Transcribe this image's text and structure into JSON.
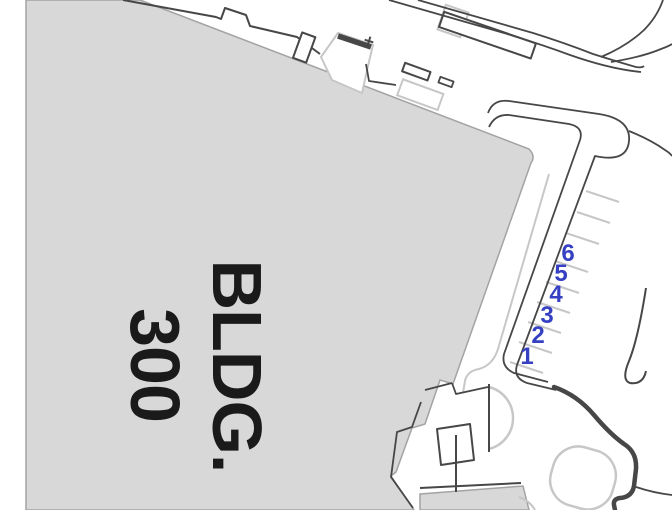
{
  "building": {
    "name_line1": "BLDG.",
    "name_line2": "300"
  },
  "parking": {
    "space_labels": [
      "1",
      "2",
      "3",
      "4",
      "5",
      "6"
    ]
  },
  "markers": {
    "cross": "+"
  },
  "colors": {
    "background": "#ffffff",
    "building_fill": "#d8d8d8",
    "building_outline": "#a3a3a3",
    "line_dark": "#474747",
    "line_light": "#c7c7c7",
    "parking_number": "#3540c2",
    "label_text": "#1a1a1a"
  }
}
